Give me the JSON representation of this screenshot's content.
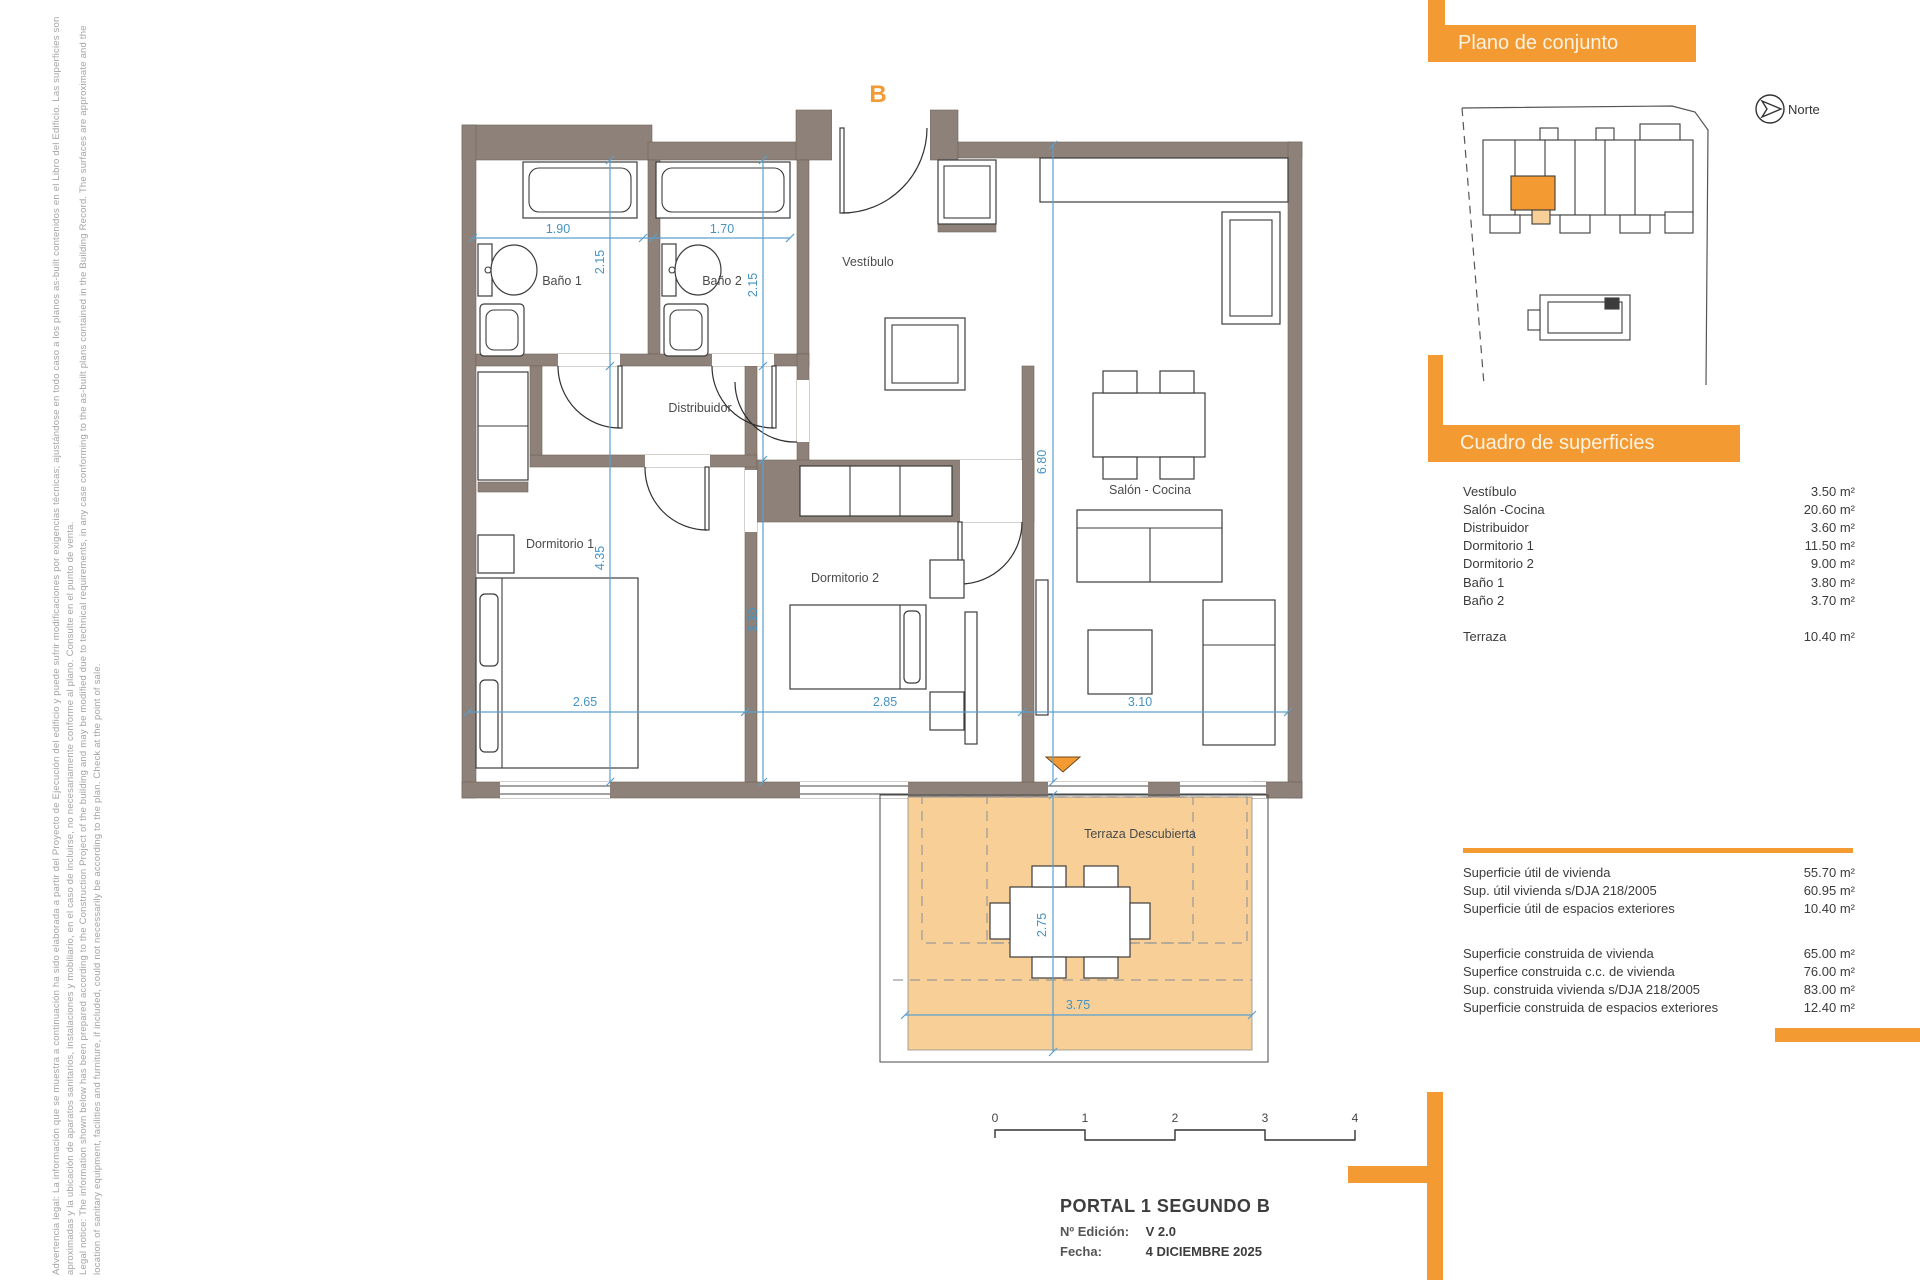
{
  "colors": {
    "accent": "#F39A33",
    "terrace_fill": "#F8CF96",
    "wall": "#8E8179",
    "dim_blue": "#4593C4"
  },
  "legal": {
    "lines": [
      "Advertencia legal: La información que se muestra a continuación ha sido elaborada a partir del Proyecto de Ejecución del edificio y puede sufrir modificaciones por exigencias técnicas; ajustándose en todo caso a los planos as-built contenidos en el Libro del Edificio. Las superficies son",
      "aproximadas y la ubicación de aparatos sanitarios, instalaciones y mobiliario, en el caso de incluirse, no necesariamente conforme al plano. Consulte en el punto de venta.",
      "Legal notice: The information shown below has been prepared according to the Construction Project of the building and may be modified due to technical requirements, in any case conforming to the as-built plans contained in the Building Record. The surfaces are approximate and the",
      "location of sanitary equipment, facilities and furniture, if included, could not necessarily be according to the plan. Check at the point of sale."
    ]
  },
  "plan": {
    "unit_letter": "B",
    "rooms": [
      {
        "label": "Baño 1"
      },
      {
        "label": "Baño 2"
      },
      {
        "label": "Vestíbulo"
      },
      {
        "label": "Distribuidor"
      },
      {
        "label": "Dormitorio 1"
      },
      {
        "label": "Dormitorio 2"
      },
      {
        "label": "Salón - Cocina"
      },
      {
        "label": "Terraza Descubierta"
      }
    ],
    "dims": {
      "bano1_w": "1.90",
      "bano2_w": "1.70",
      "bano1_h": "2.15",
      "bano2_h": "2.15",
      "dorm1_h": "4.35",
      "dorm2_h": "3.30",
      "salon_h": "6.80",
      "dorm1_w": "2.65",
      "dorm2_w": "2.85",
      "salon_w": "3.10",
      "terraza_h": "2.75",
      "terraza_w": "3.75"
    }
  },
  "overview": {
    "title": "Plano de conjunto",
    "north_label": "Norte"
  },
  "surfaces": {
    "title": "Cuadro de superficies",
    "rows": [
      {
        "label": "Vestíbulo",
        "value": "3.50 m²"
      },
      {
        "label": "Salón -Cocina",
        "value": "20.60 m²"
      },
      {
        "label": "Distribuidor",
        "value": "3.60 m²"
      },
      {
        "label": "Dormitorio 1",
        "value": "11.50 m²"
      },
      {
        "label": "Dormitorio 2",
        "value": "9.00 m²"
      },
      {
        "label": "Baño 1",
        "value": "3.80 m²"
      },
      {
        "label": "Baño 2",
        "value": "3.70 m²"
      }
    ],
    "terraza": {
      "label": "Terraza",
      "value": "10.40 m²"
    }
  },
  "summary": {
    "util_rows": [
      {
        "label": "Superficie útil de vivienda",
        "value": "55.70 m²"
      },
      {
        "label": "Sup. útil vivienda s/DJA 218/2005",
        "value": "60.95 m²"
      },
      {
        "label": "Superficie útil de espacios exteriores",
        "value": "10.40 m²"
      }
    ],
    "built_rows": [
      {
        "label": "Superficie construida de vivienda",
        "value": "65.00 m²"
      },
      {
        "label": "Superfice construida c.c. de vivienda",
        "value": "76.00 m²"
      },
      {
        "label": "Sup. construida vivienda s/DJA 218/2005",
        "value": "83.00 m²"
      },
      {
        "label": "Superficie construida de espacios exteriores",
        "value": "12.40 m²"
      }
    ]
  },
  "scalebar": {
    "ticks": [
      "0",
      "1",
      "2",
      "3",
      "4"
    ]
  },
  "titleblock": {
    "title": "PORTAL 1 SEGUNDO B",
    "edition_label": "Nº Edición:",
    "edition_value": "V 2.0",
    "date_label": "Fecha:",
    "date_value": "4 DICIEMBRE 2025"
  }
}
